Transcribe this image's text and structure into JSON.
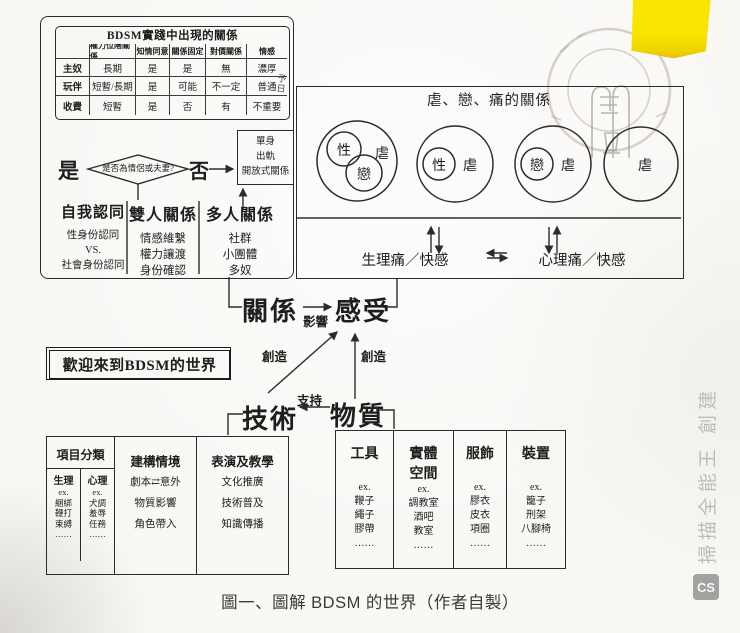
{
  "scan": {
    "caption": "圖一、圖解 BDSM 的世界（作者自製）",
    "watermark_text": "掃描全能王 創建",
    "watermark_logo": "CS"
  },
  "relation_table": {
    "title": "BDSM實踐中出現的關係",
    "col_headers": [
      "權力位階關係",
      "知情同意",
      "關係固定",
      "對價關係",
      "情感"
    ],
    "rows": [
      {
        "label": "主奴",
        "cells": [
          "長期",
          "是",
          "是",
          "無",
          "濃厚"
        ]
      },
      {
        "label": "玩伴",
        "cells": [
          "短暫/長期",
          "是",
          "可能",
          "不一定",
          "普通"
        ]
      },
      {
        "label": "收費",
        "cells": [
          "短暫",
          "是",
          "否",
          "有",
          "不重要"
        ]
      }
    ],
    "margin_note": "予日"
  },
  "flow": {
    "question": "是否為情侶或夫妻?",
    "yes": "是",
    "no": "否",
    "no_box_lines": [
      "單身",
      "出軌",
      "開放式關係"
    ]
  },
  "identity_groups": [
    {
      "title": "自我認同",
      "items": [
        "性身份認同",
        "VS.",
        "社會身份認同"
      ]
    },
    {
      "title": "雙人關係",
      "items": [
        "情感維繫",
        "權力讓渡",
        "身份確認"
      ]
    },
    {
      "title": "多人關係",
      "items": [
        "社群",
        "小團體",
        "多奴"
      ]
    }
  ],
  "sm_relation_box": {
    "title": "虐、戀、痛的關係",
    "venn_labels": {
      "sex": "性",
      "love": "戀",
      "sadism": "虐"
    },
    "physical": "生理痛／快感",
    "psychological": "心理痛／快感"
  },
  "core_map": {
    "relation": "關係",
    "feeling": "感受",
    "influence": "影響",
    "create_left": "創造",
    "create_right": "創造",
    "support": "支持",
    "technique": "技術",
    "material": "物質",
    "welcome": "歡迎來到BDSM的世界"
  },
  "technique_table": {
    "columns": [
      {
        "title": "項目分類",
        "sub": [
          {
            "title": "生理",
            "items": [
              "ex.",
              "綑綁",
              "鞭打",
              "束縛",
              "……"
            ]
          },
          {
            "title": "心理",
            "items": [
              "ex.",
              "犬調",
              "羞辱",
              "任務",
              "……"
            ]
          }
        ]
      },
      {
        "title": "建構情境",
        "items": [
          "劇本⇄意外",
          "物質影響",
          "角色帶入"
        ]
      },
      {
        "title": "表演及教學",
        "items": [
          "文化推廣",
          "技術普及",
          "知識傳播"
        ]
      }
    ]
  },
  "material_table": {
    "columns": [
      {
        "title": "工具",
        "items": [
          "ex.",
          "鞭子",
          "繩子",
          "膠帶",
          "……"
        ]
      },
      {
        "title": "實體空間",
        "items": [
          "ex.",
          "調教室",
          "酒吧",
          "教室",
          "……"
        ]
      },
      {
        "title": "服飾",
        "items": [
          "ex.",
          "膠衣",
          "皮衣",
          "項圈",
          "……"
        ]
      },
      {
        "title": "裝置",
        "items": [
          "ex.",
          "籠子",
          "刑架",
          "八腳椅",
          "……"
        ]
      }
    ]
  }
}
